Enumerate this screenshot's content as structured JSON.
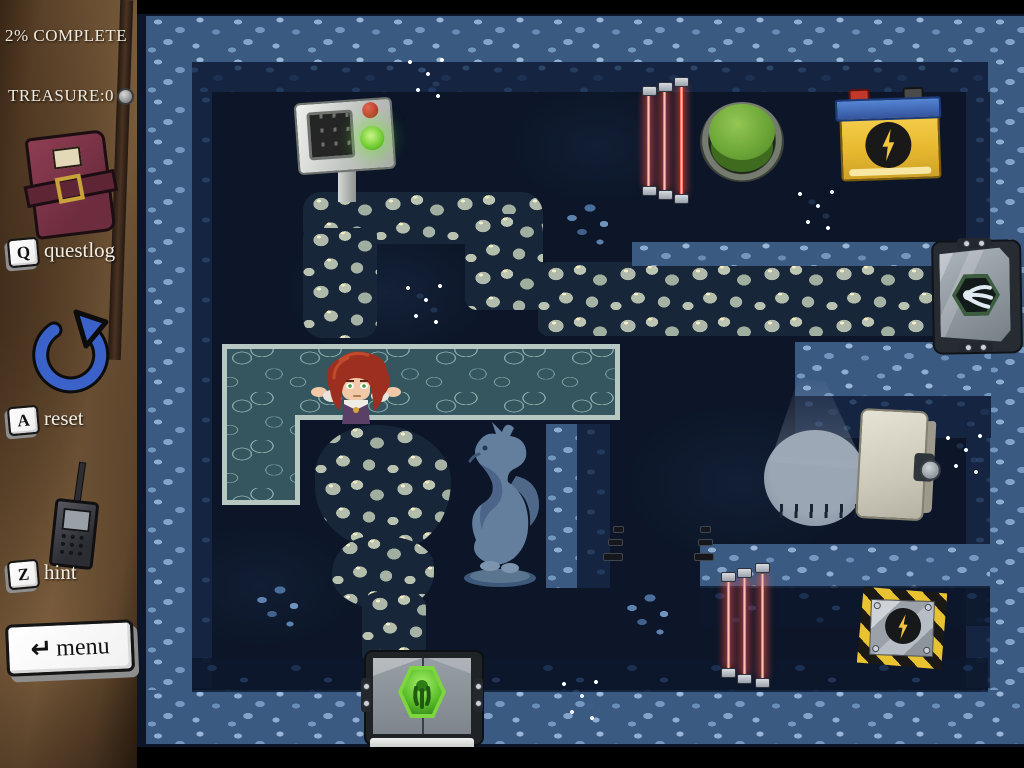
{
  "hud": {
    "progress": "2% COMPLETE",
    "treasure": "TREASURE:0",
    "questlog": {
      "key": "Q",
      "label": "questlog"
    },
    "reset": {
      "key": "A",
      "label": "reset"
    },
    "hint": {
      "key": "Z",
      "label": "hint"
    },
    "menu": {
      "icon": "↵",
      "label": "menu"
    }
  },
  "icons": [
    "questlog-book-icon",
    "reset-circular-arrow-icon",
    "hint-radio-icon",
    "menu-return-key-icon",
    "wing-emblem-icon",
    "lightning-bolt-icon"
  ],
  "colors": {
    "laser_red": "#ff5e50",
    "button_green": "#6faf39",
    "emblem_green": "#7ed63e",
    "battery_yellow": "#f2c63c",
    "battery_blue": "#3f6fc4",
    "hedge_blue": "#7f9fc6",
    "water_teal": "#35565f",
    "stone_gray": "#aeb9ab",
    "sidebar_brown": "#6f5335",
    "hud_text": "#efe9dc",
    "hazard_yellow": "#e9c232"
  },
  "scene": {
    "objects": [
      "control-terminal",
      "upper-laser-gate",
      "big-green-button",
      "battery",
      "stone-path",
      "exit-door-right",
      "highlighted-water-pool",
      "player-character",
      "dragon-statue",
      "hedge-maze",
      "spotlight",
      "safe",
      "hazard-floor-plate",
      "lower-laser-gate",
      "exit-door-bottom",
      "off-laser-emitters",
      "flower-patches"
    ]
  }
}
